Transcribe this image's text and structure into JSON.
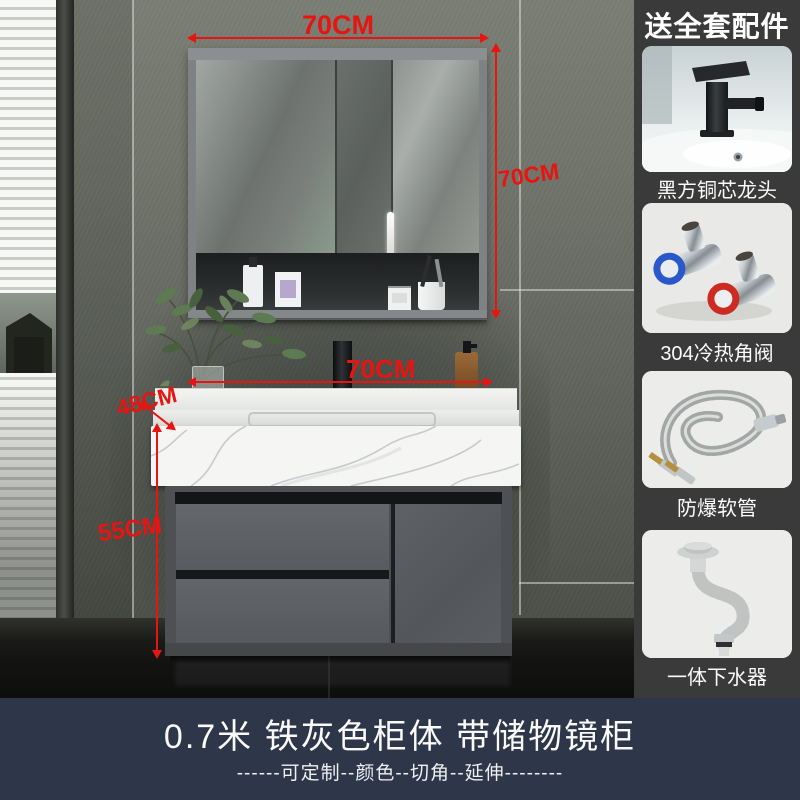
{
  "sidebar": {
    "header": "送全套配件",
    "items": [
      {
        "name": "black-square-faucet",
        "label": "黑方铜芯龙头"
      },
      {
        "name": "hot-cold-angle-valves",
        "label": "304冷热角阀"
      },
      {
        "name": "burst-proof-hoses",
        "label": "防爆软管"
      },
      {
        "name": "integrated-drain",
        "label": "一体下水器"
      }
    ]
  },
  "scene": {
    "dimensions": {
      "mirror_width": "70CM",
      "mirror_height": "70CM",
      "counter_width": "70CM",
      "counter_depth": "48CM",
      "cabinet_height": "55CM"
    }
  },
  "footer": {
    "title": "0.7米  铁灰色柜体  带储物镜柜",
    "subtitle": "------可定制--颜色--切角--延伸--------"
  },
  "colors": {
    "dimension_red": "#e81410",
    "sidebar_bg": "#3a3a3a",
    "footer_bg": "#2e3749",
    "card_bg": "#efefef",
    "cabinet_gray": "#57595c"
  }
}
